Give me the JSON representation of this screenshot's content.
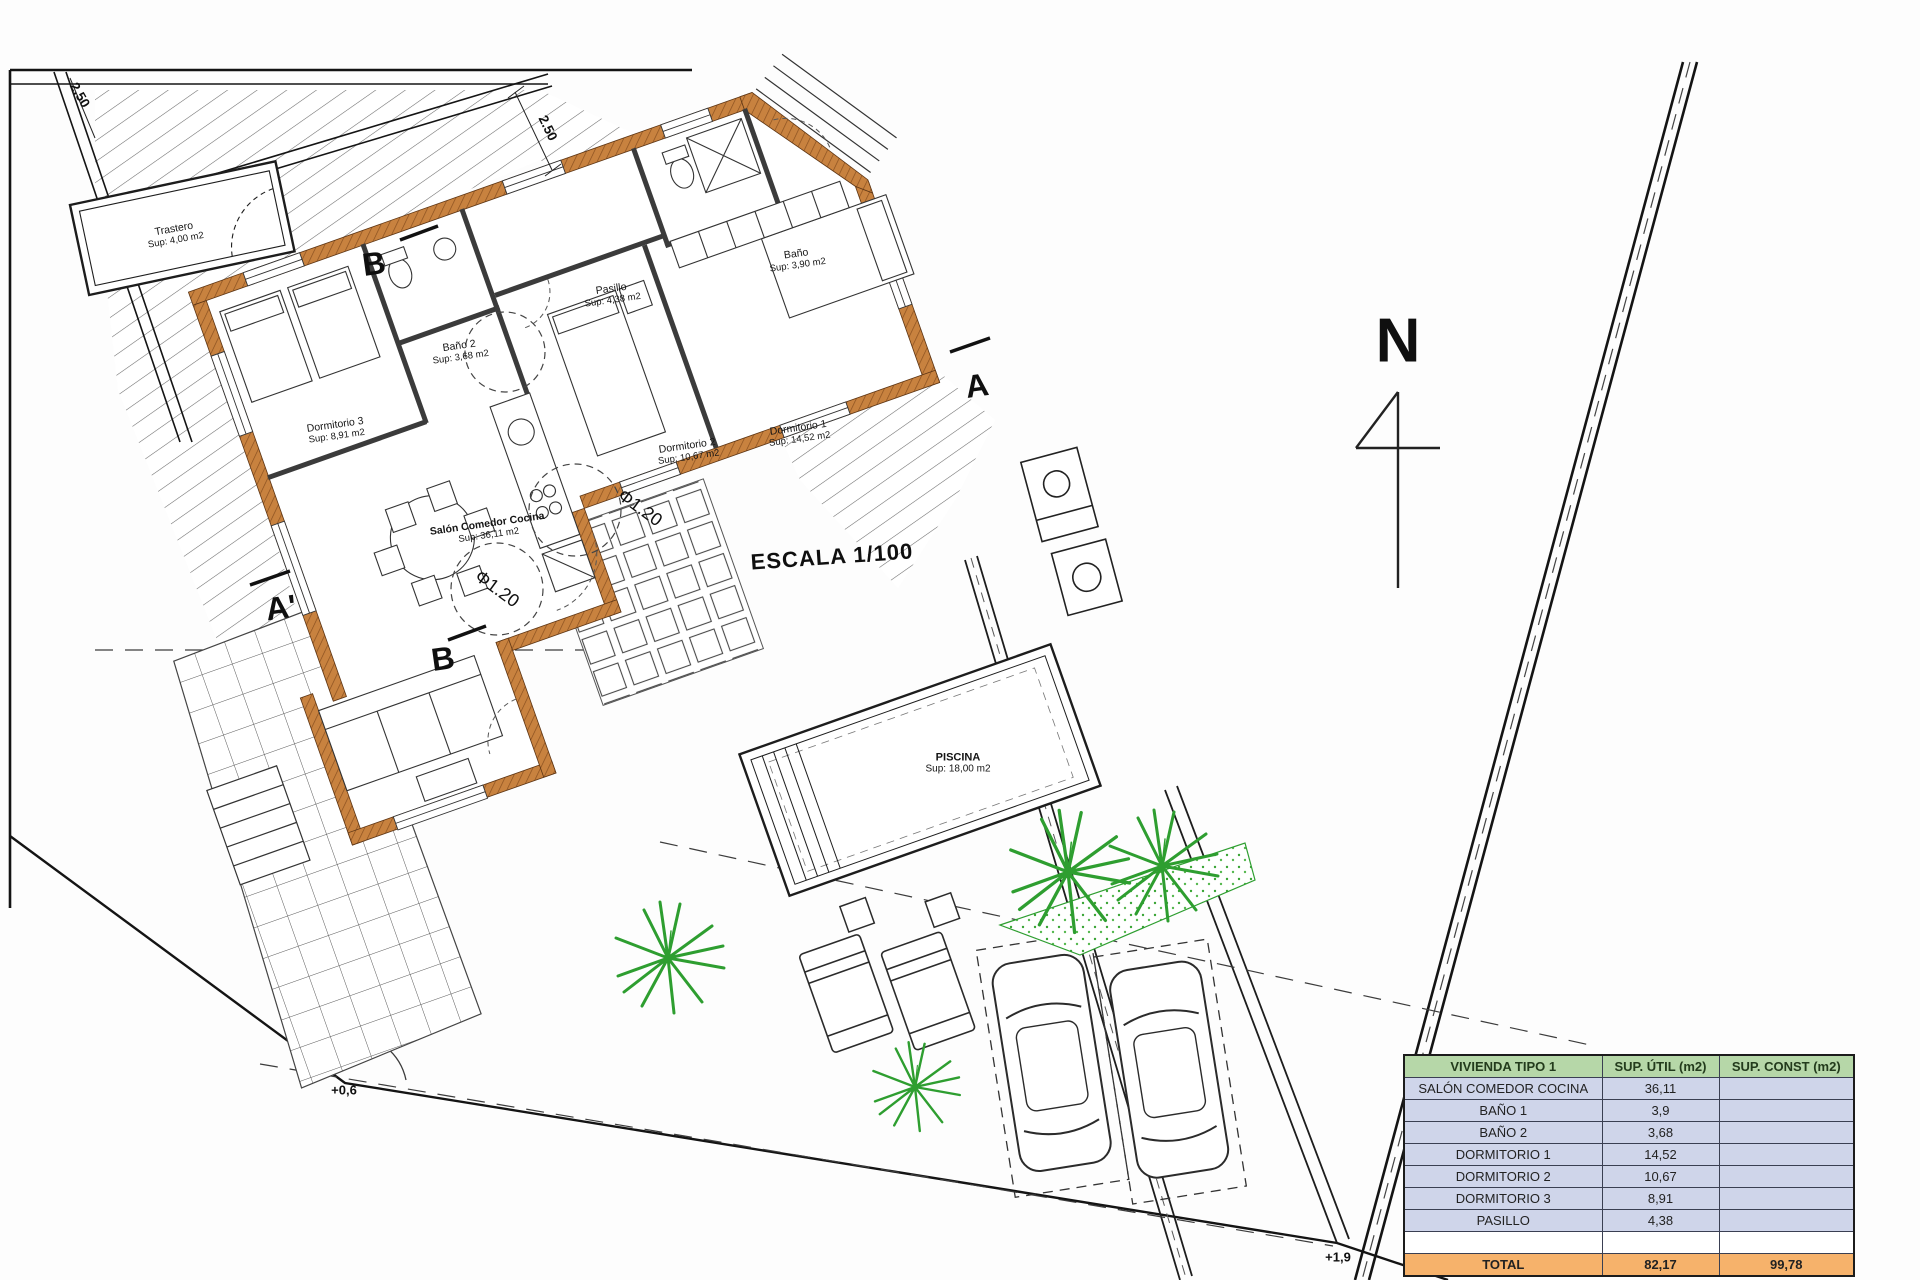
{
  "rooms": {
    "trastero": {
      "name": "Trastero",
      "sup": "Sup: 4,00 m2"
    },
    "pasillo": {
      "name": "Pasillo",
      "sup": "Sup: 4,38 m2"
    },
    "bano1": {
      "name": "Baño",
      "sup": "Sup: 3,90 m2"
    },
    "bano2": {
      "name": "Baño 2",
      "sup": "Sup: 3,68 m2"
    },
    "dormitorio1": {
      "name": "Dormitorio 1",
      "sup": "Sup: 14,52 m2"
    },
    "dormitorio2": {
      "name": "Dormitorio 2",
      "sup": "Sup: 10,67 m2"
    },
    "dormitorio3": {
      "name": "Dormitorio 3",
      "sup": "Sup: 8,91 m2"
    },
    "salon": {
      "name": "Salón Comedor Cocina",
      "sup": "Sup: 36,11 m2"
    },
    "piscina": {
      "name": "PISCINA",
      "sup": "Sup: 18,00 m2"
    }
  },
  "annotations": {
    "escala": "ESCALA 1/100",
    "north_letter": "N",
    "section_a": "A",
    "section_a_prime": "A'",
    "section_b_top": "B",
    "section_b_bottom": "B",
    "level_entrance": "+0,6",
    "level_road": "+1,9",
    "dim_top": "2.50",
    "dim_corner": "2.50",
    "turning_circle_1": "Φ1.20",
    "turning_circle_2": "Φ1.20"
  },
  "table": {
    "headers": [
      "VIVIENDA TIPO 1",
      "SUP. ÚTIL (m2)",
      "SUP. CONST (m2)"
    ],
    "rows": [
      [
        "SALÓN COMEDOR COCINA",
        "36,11",
        ""
      ],
      [
        "BAÑO 1",
        "3,9",
        ""
      ],
      [
        "BAÑO 2",
        "3,68",
        ""
      ],
      [
        "DORMITORIO 1",
        "14,52",
        ""
      ],
      [
        "DORMITORIO 2",
        "10,67",
        ""
      ],
      [
        "DORMITORIO 3",
        "8,91",
        ""
      ],
      [
        "PASILLO",
        "4,38",
        ""
      ],
      [
        "",
        "",
        ""
      ]
    ],
    "total": [
      "TOTAL",
      "82,17",
      "99,78"
    ]
  },
  "colors": {
    "header_bg": "#b6d7a8",
    "row_bg": "#cfd5ea",
    "total_bg": "#f6b26b",
    "wall": "#c8823f",
    "plant": "#2e9e30"
  }
}
